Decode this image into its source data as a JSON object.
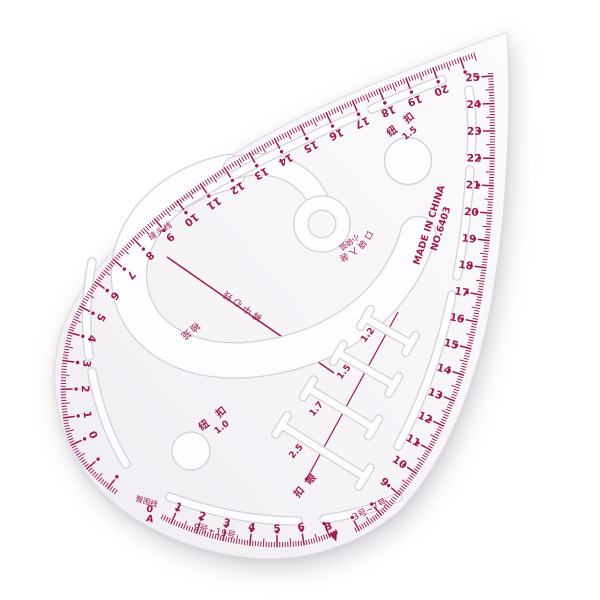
{
  "colors": {
    "ink": "#9c1b50",
    "body_tint": "#f4f1f5",
    "cutout": "#fdfdff",
    "cutout_edge": "#d6d2d8",
    "background": "#ffffff"
  },
  "ruler": {
    "made_in": "MADE IN CHINA",
    "model_no": "NO.6403",
    "scales": {
      "left_top": {
        "name": "left-top edge cm scale",
        "numbers": [
          0,
          1,
          2,
          3,
          4,
          5,
          6,
          7,
          8,
          9,
          10,
          11,
          12,
          13,
          14,
          15,
          16,
          17,
          18,
          19,
          20
        ]
      },
      "right": {
        "name": "right edge cm scale",
        "numbers": [
          25,
          24,
          23,
          22,
          21,
          20,
          19,
          18,
          17,
          16,
          15,
          14,
          13,
          12,
          11,
          10,
          9
        ]
      },
      "bottom": {
        "name": "bottom edge cm scale",
        "numbers": [
          1,
          2,
          3,
          4,
          5,
          6
        ]
      }
    },
    "labels": {
      "button_large": {
        "cn": "纽 扣",
        "value": "1.5"
      },
      "button_small": {
        "cn": "纽 扣",
        "value": "1.0"
      },
      "buttonhole": "扣 眼",
      "seam_edge_line": "缝头线",
      "armhole": "袖笼",
      "pant_center_line": "裤中心线",
      "pocket_curve": "口袋入装",
      "small_pocket": "小袋弧",
      "hip_line": "臀围线",
      "size_range_large": "9号~19号",
      "size_range_small": "3号~7号",
      "origin_zero": "0",
      "origin_a": "A",
      "point_b": "B"
    },
    "buttonholes": [
      {
        "size": "1.2"
      },
      {
        "size": "1.5"
      },
      {
        "size": "1.7"
      },
      {
        "size": "2.5"
      }
    ]
  }
}
